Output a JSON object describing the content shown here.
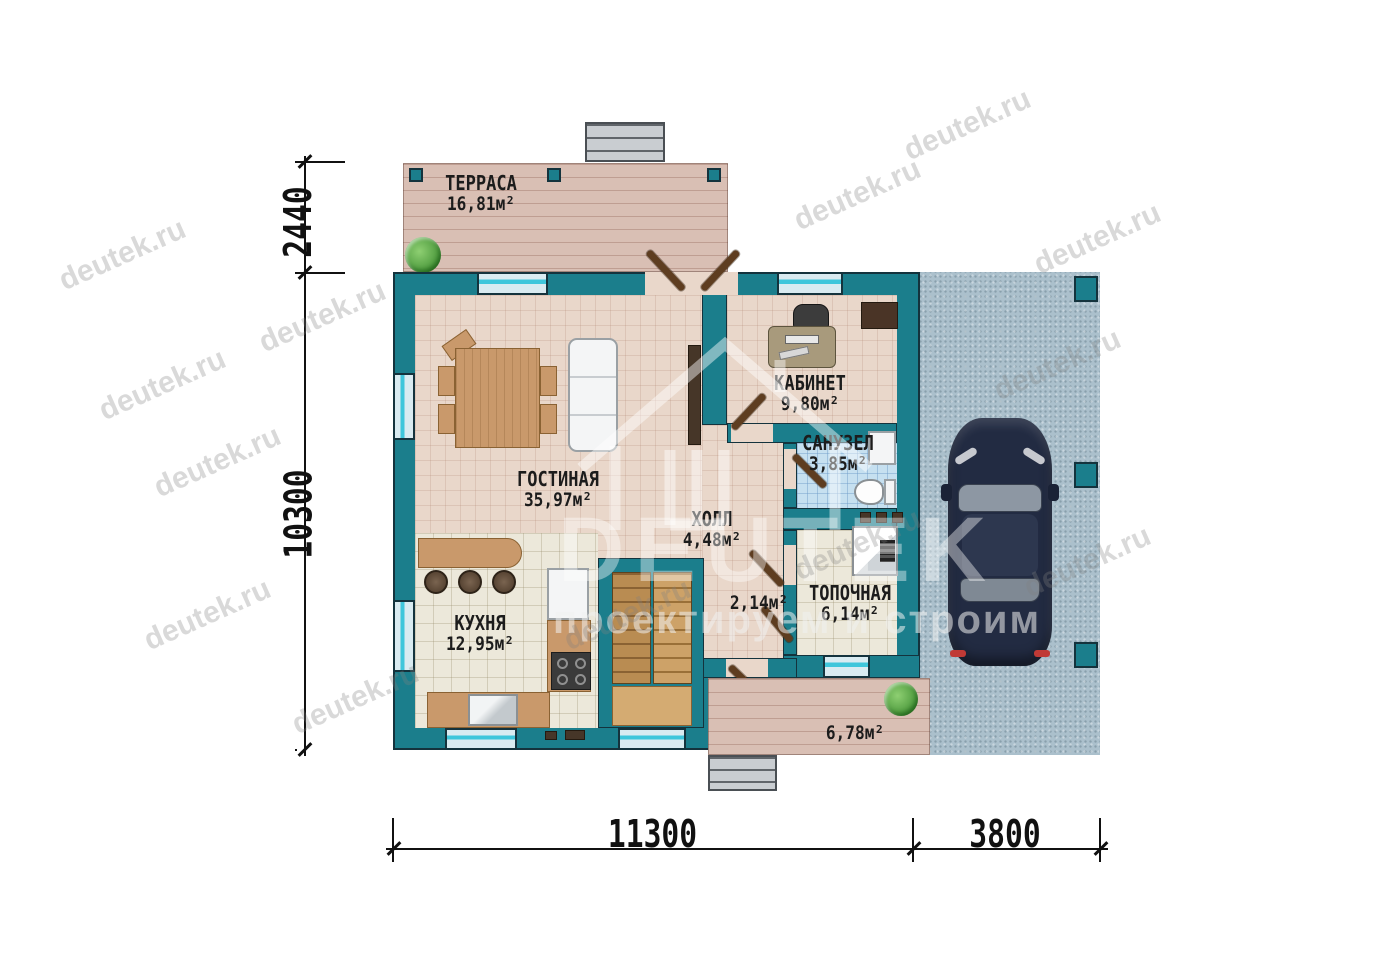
{
  "watermark": {
    "text": "deutek.ru"
  },
  "logo": {
    "name": "DEUTEK",
    "tagline": "проектируем и строим"
  },
  "rooms": {
    "terrace": {
      "name": "ТЕРРАСА",
      "area": "16,81м²"
    },
    "living": {
      "name": "ГОСТИНАЯ",
      "area": "35,97м²"
    },
    "office": {
      "name": "КАБИНЕТ",
      "area": "9,80м²"
    },
    "bathroom": {
      "name": "САНУЗЕЛ",
      "area": "3,85м²"
    },
    "hall": {
      "name": "ХОЛЛ",
      "area": "4,48м²"
    },
    "kitchen": {
      "name": "КУХНЯ",
      "area": "12,95м²"
    },
    "boiler": {
      "name": "ТОПОЧНАЯ",
      "area": "6,14м²"
    },
    "corridor": {
      "area": "2,14м²"
    },
    "porch": {
      "area": "6,78м²"
    }
  },
  "dimensions": {
    "terrace_depth": "2440",
    "house_depth": "10300",
    "house_width": "11300",
    "carport_width": "3800"
  },
  "colors": {
    "wall": "#1b7e8c",
    "wallOutline": "#14333d",
    "windowCyan": "#3fc6db",
    "floorBeige": "#e9d7ca",
    "floorKitchen": "#ece8da",
    "floorBath": "#c6e0f0",
    "deck": "#d9bfb4",
    "carport": "#abc0cc",
    "wood": "#c9996b",
    "car": "#222b42"
  }
}
